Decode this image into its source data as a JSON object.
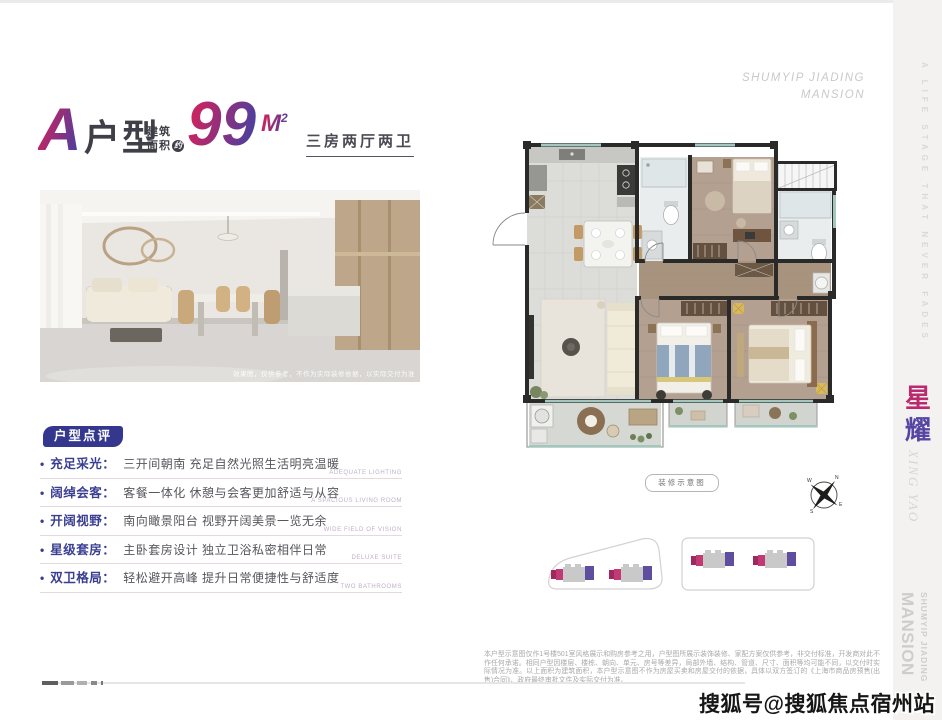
{
  "header": {
    "type_letter": "A",
    "type_word": "户型",
    "area_prefix_1": "建筑",
    "area_prefix_2": "面积",
    "area_circle": "约",
    "area_number": "99",
    "area_unit": "M",
    "area_sup": "2",
    "layout_text": "三房两厅两卫"
  },
  "photo": {
    "caption": "效果图，仅供参考，不作为实际装修依据，以实际交付为准"
  },
  "review": {
    "badge": "户型点评",
    "items": [
      {
        "label": "充足采光：",
        "desc": "三开间朝南 充足自然光照生活明亮温暖",
        "en": "ADEQUATE LIGHTING"
      },
      {
        "label": "阔绰会客：",
        "desc": "客餐一体化 休憩与会客更加舒适与从容",
        "en": "A SPACIOUS LIVING ROOM"
      },
      {
        "label": "开阔视野：",
        "desc": "南向瞰景阳台 视野开阔美景一览无余",
        "en": "WIDE FIELD OF VISION"
      },
      {
        "label": "星级套房：",
        "desc": "主卧套房设计 独立卫浴私密相伴日常",
        "en": "DELUXE SUITE"
      },
      {
        "label": "双卫格局：",
        "desc": "轻松避开高峰 提升日常便捷性与舒适度",
        "en": "TWO BATHROOMS"
      }
    ]
  },
  "plan": {
    "caption": "装修示意图",
    "compass": {
      "n": "N",
      "e": "E",
      "s": "S",
      "w": "W"
    }
  },
  "brand": {
    "name_line1": "SHUMYIP JIADING",
    "name_line2": "MANSION",
    "strip_tagline": "A LIFE STAGE THAT NEVER FADES",
    "cn_char_1": "星",
    "cn_char_2": "耀",
    "pinyin": "XING YAO",
    "strip_name_1": "SHUMYIP JIADING",
    "strip_name_2": "MANSION"
  },
  "footer": {
    "disclaimer": "本户型示意图仅作1号楼501室风格展示和购房参考之用，户型图所展示装饰装修、家配方案仅供参考，非交付标准，开发商对此不作任何承诺。相同户型因楼层、楼栋、朝向、单元、房号等差异，局部外墙、结构、管道、尺寸、面积等均可能不同，以交付时实际情况为准。以上面积为建筑面积，本户型示意图不作为房屋买卖和房屋交付的依据，具体以双方签订的《上海市商品房预售(出售)合同》、政府最终审批文件及实际交付为准。",
    "watermark": "搜狐号@搜狐焦点宿州站"
  },
  "colors": {
    "magenta": "#c82462",
    "purple": "#4b3f9e",
    "badge_indigo": "#34378d",
    "label_blue": "#3a3e92",
    "window_teal": "#a3c6be",
    "wood_floor": "#b3a091",
    "strip_bg": "#f3f2f0"
  }
}
